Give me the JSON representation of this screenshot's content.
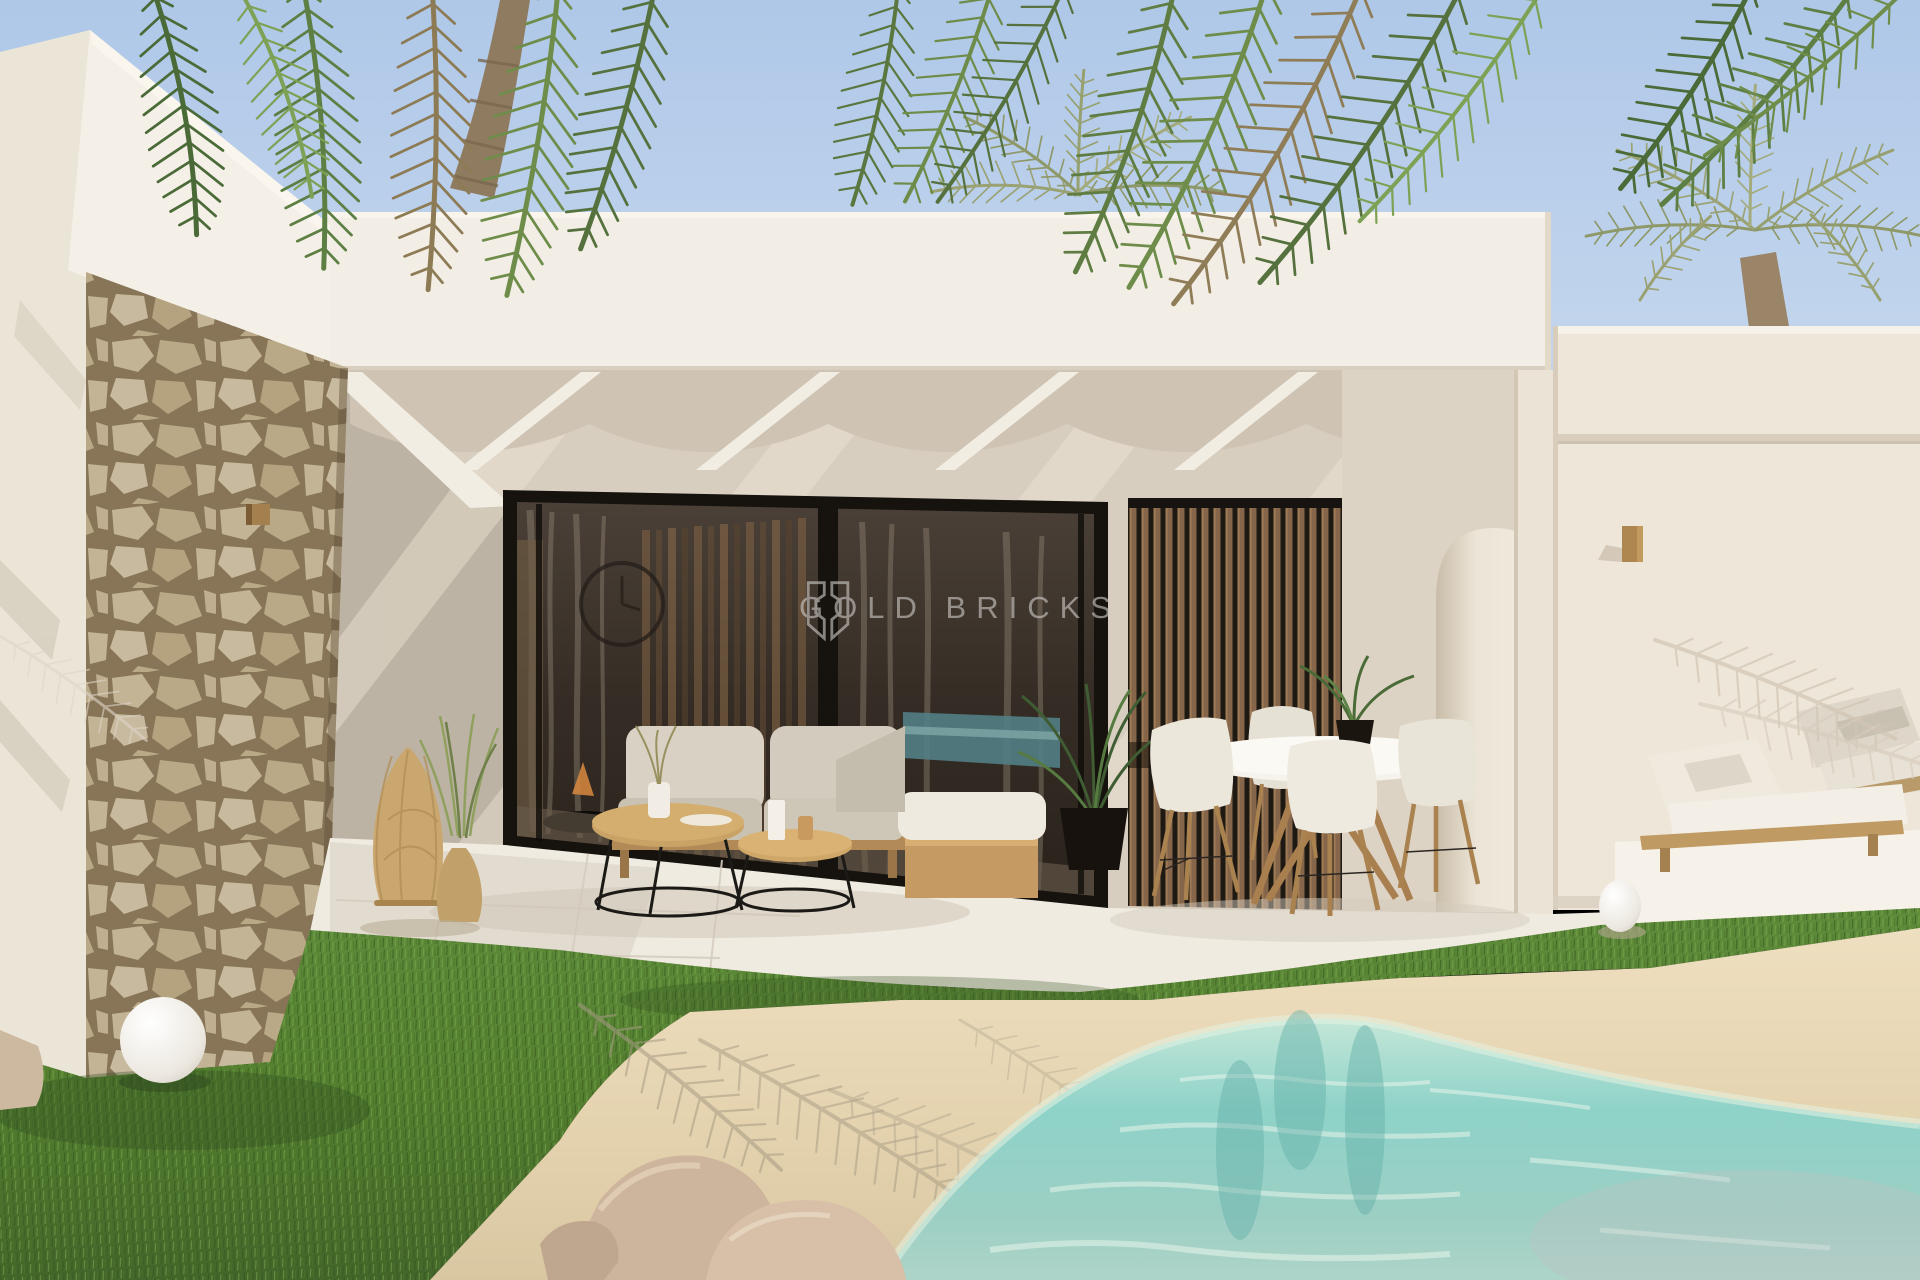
{
  "watermark": {
    "brand": "GOLD BRICKS"
  },
  "palette": {
    "sky_top": "#b3cbe9",
    "sky_bottom": "#d2e0f1",
    "wall_white": "#f3eee5",
    "wall_shade": "#eee6d9",
    "terrace_wall": "#d8cec0",
    "soffit": "#cfc4b3",
    "stone": "#cfbf9e",
    "stone_joint": "#8a7758",
    "glass_dark": "#372f27",
    "frame_black": "#16120e",
    "wood_slat": "#8a684a",
    "wood_light": "#c49e66",
    "cushion": "#d9d2c4",
    "grass_light": "#6f9c46",
    "grass_dark": "#3f6128",
    "sand": "#ecdcbc",
    "sand_shade": "#cfc1a2",
    "water_shallow": "#cdeadd",
    "water_mid": "#8ed2c8",
    "water_deep": "#9fcfc3",
    "watermark_color": "#c9c5c1"
  }
}
